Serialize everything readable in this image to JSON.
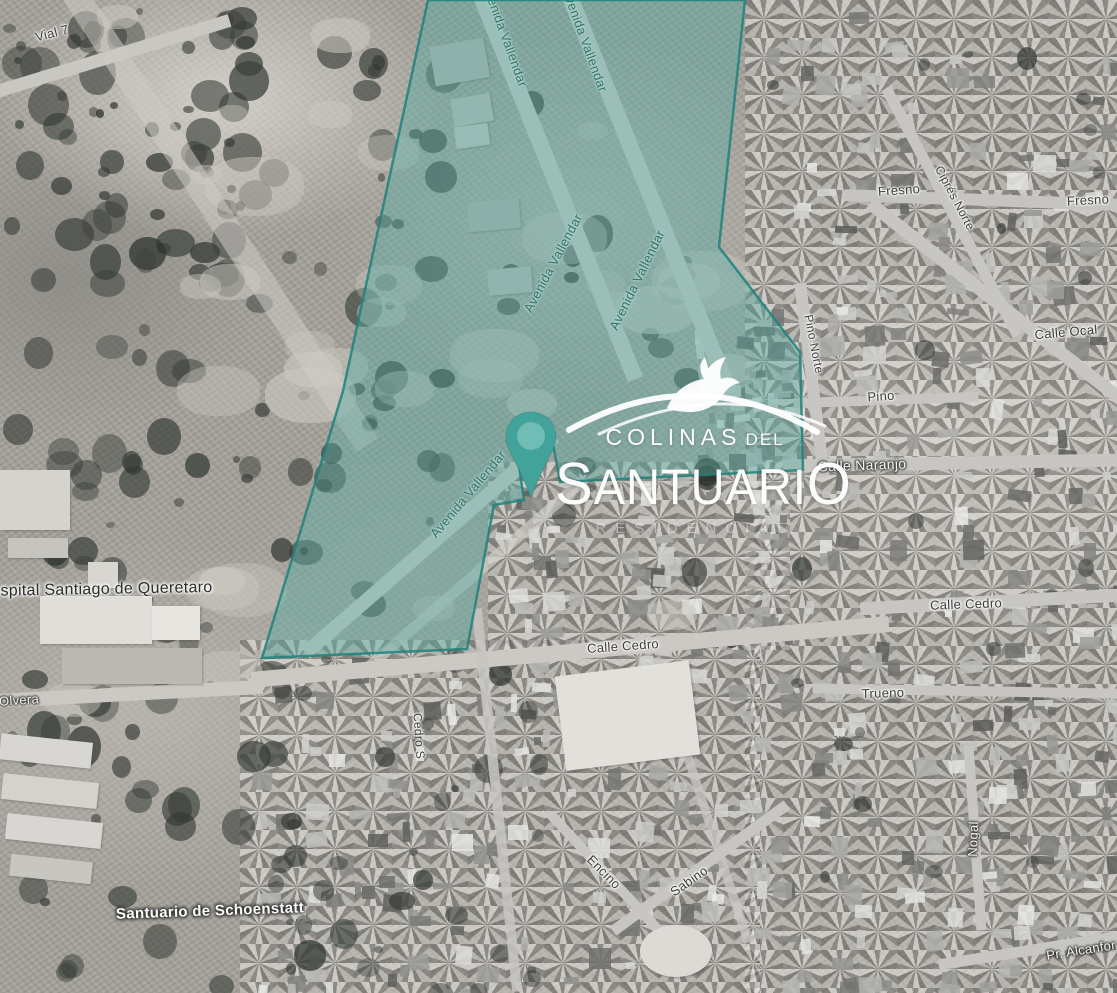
{
  "map": {
    "imagery": "grayscale-satellite",
    "accent_color": "#3da59b",
    "overlay": {
      "fill": "#53aca2",
      "fill_opacity": 0.42,
      "stroke": "#1f837b",
      "points": "428,0 745,0 719,247 800,352 803,470 560,482 550,428 515,440 524,500 494,505 467,649 262,658 343,391"
    },
    "pin": {
      "color": "#41a39a",
      "inner_color": "#6fbdb4"
    },
    "street_labels": [
      {
        "id": "vial-7",
        "text": "Vial 7",
        "cx": 52,
        "cy": 33,
        "rot": -14,
        "style": "dark",
        "size": 13
      },
      {
        "id": "avenida-vallendar-top-1",
        "text": "Avenida Vallendar",
        "cx": 505,
        "cy": 35,
        "rot": 70,
        "style": "teal",
        "size": 13,
        "under": true
      },
      {
        "id": "avenida-vallendar-top-2",
        "text": "Avenida Vallendar",
        "cx": 585,
        "cy": 40,
        "rot": 70,
        "style": "teal",
        "size": 13,
        "under": true
      },
      {
        "id": "avenida-vallendar-mid-1",
        "text": "Avenida Vallendar",
        "cx": 553,
        "cy": 263,
        "rot": -62,
        "style": "teal",
        "size": 13,
        "under": true
      },
      {
        "id": "avenida-vallendar-mid-2",
        "text": "Avenida Vallendar",
        "cx": 637,
        "cy": 280,
        "rot": -64,
        "style": "teal",
        "size": 13,
        "under": true
      },
      {
        "id": "avenida-vallendar-pin",
        "text": "Avenida Vallendar",
        "cx": 468,
        "cy": 494,
        "rot": -50,
        "style": "teal",
        "size": 13,
        "under": true
      },
      {
        "id": "fresno-west",
        "text": "Fresno",
        "cx": 899,
        "cy": 190,
        "rot": -4,
        "style": "dark",
        "size": 13
      },
      {
        "id": "cipres-norte",
        "text": "Ciprés Norte",
        "cx": 955,
        "cy": 198,
        "rot": 62,
        "style": "dark",
        "size": 12
      },
      {
        "id": "fresno-east",
        "text": "Fresno",
        "cx": 1088,
        "cy": 200,
        "rot": -3,
        "style": "dark",
        "size": 13
      },
      {
        "id": "calle-ocal",
        "text": "Calle Ocal",
        "cx": 1066,
        "cy": 332,
        "rot": -5,
        "style": "dark",
        "size": 13
      },
      {
        "id": "pino-norte",
        "text": "Pino Norte",
        "cx": 814,
        "cy": 344,
        "rot": 79,
        "style": "dark",
        "size": 12
      },
      {
        "id": "pino",
        "text": "Pino",
        "cx": 881,
        "cy": 396,
        "rot": -4,
        "style": "dark",
        "size": 13
      },
      {
        "id": "calle-naranjo",
        "text": "Calle Naranjo",
        "cx": 862,
        "cy": 465,
        "rot": -2,
        "style": "light",
        "size": 14
      },
      {
        "id": "calle-cedro-east",
        "text": "Calle Cedro",
        "cx": 966,
        "cy": 604,
        "rot": -2,
        "style": "dark",
        "size": 13
      },
      {
        "id": "calle-cedro",
        "text": "Calle Cedro",
        "cx": 623,
        "cy": 646,
        "rot": -4,
        "style": "dark",
        "size": 13
      },
      {
        "id": "trueno",
        "text": "Trueno",
        "cx": 883,
        "cy": 693,
        "rot": -2,
        "style": "dark",
        "size": 13
      },
      {
        "id": "olvera",
        "text": "Olvera",
        "cx": 19,
        "cy": 700,
        "rot": -4,
        "style": "light",
        "size": 13
      },
      {
        "id": "cedro-sur",
        "text": "Cedro S",
        "cx": 419,
        "cy": 736,
        "rot": 86,
        "style": "dark",
        "size": 12
      },
      {
        "id": "hospital-santiago",
        "text": "Hospital Santiago de Queretaro",
        "cx": 96,
        "cy": 590,
        "rot": -1,
        "style": "poi-dark",
        "size": 16
      },
      {
        "id": "santuario-schoenstatt",
        "text": "Santuario de Schoenstatt",
        "cx": 210,
        "cy": 911,
        "rot": -2,
        "style": "poi-light",
        "size": 15
      },
      {
        "id": "encino",
        "text": "Encino",
        "cx": 604,
        "cy": 872,
        "rot": 45,
        "style": "dark",
        "size": 13
      },
      {
        "id": "sabino",
        "text": "Sabino",
        "cx": 689,
        "cy": 881,
        "rot": -35,
        "style": "dark",
        "size": 13
      },
      {
        "id": "nogal",
        "text": "Nogal",
        "cx": 973,
        "cy": 839,
        "rot": -88,
        "style": "light",
        "size": 13
      },
      {
        "id": "pr-alcanfor",
        "text": "Pr. Alcanfor",
        "cx": 1081,
        "cy": 950,
        "rot": -9,
        "style": "light",
        "size": 13
      }
    ]
  },
  "logo": {
    "brand_line1": "COLINAS",
    "brand_line1_suffix": "DEL",
    "brand_line2": "SANTUARIO",
    "brand_line3": "RESIDENCIAL",
    "icon": "dove-over-hills"
  }
}
